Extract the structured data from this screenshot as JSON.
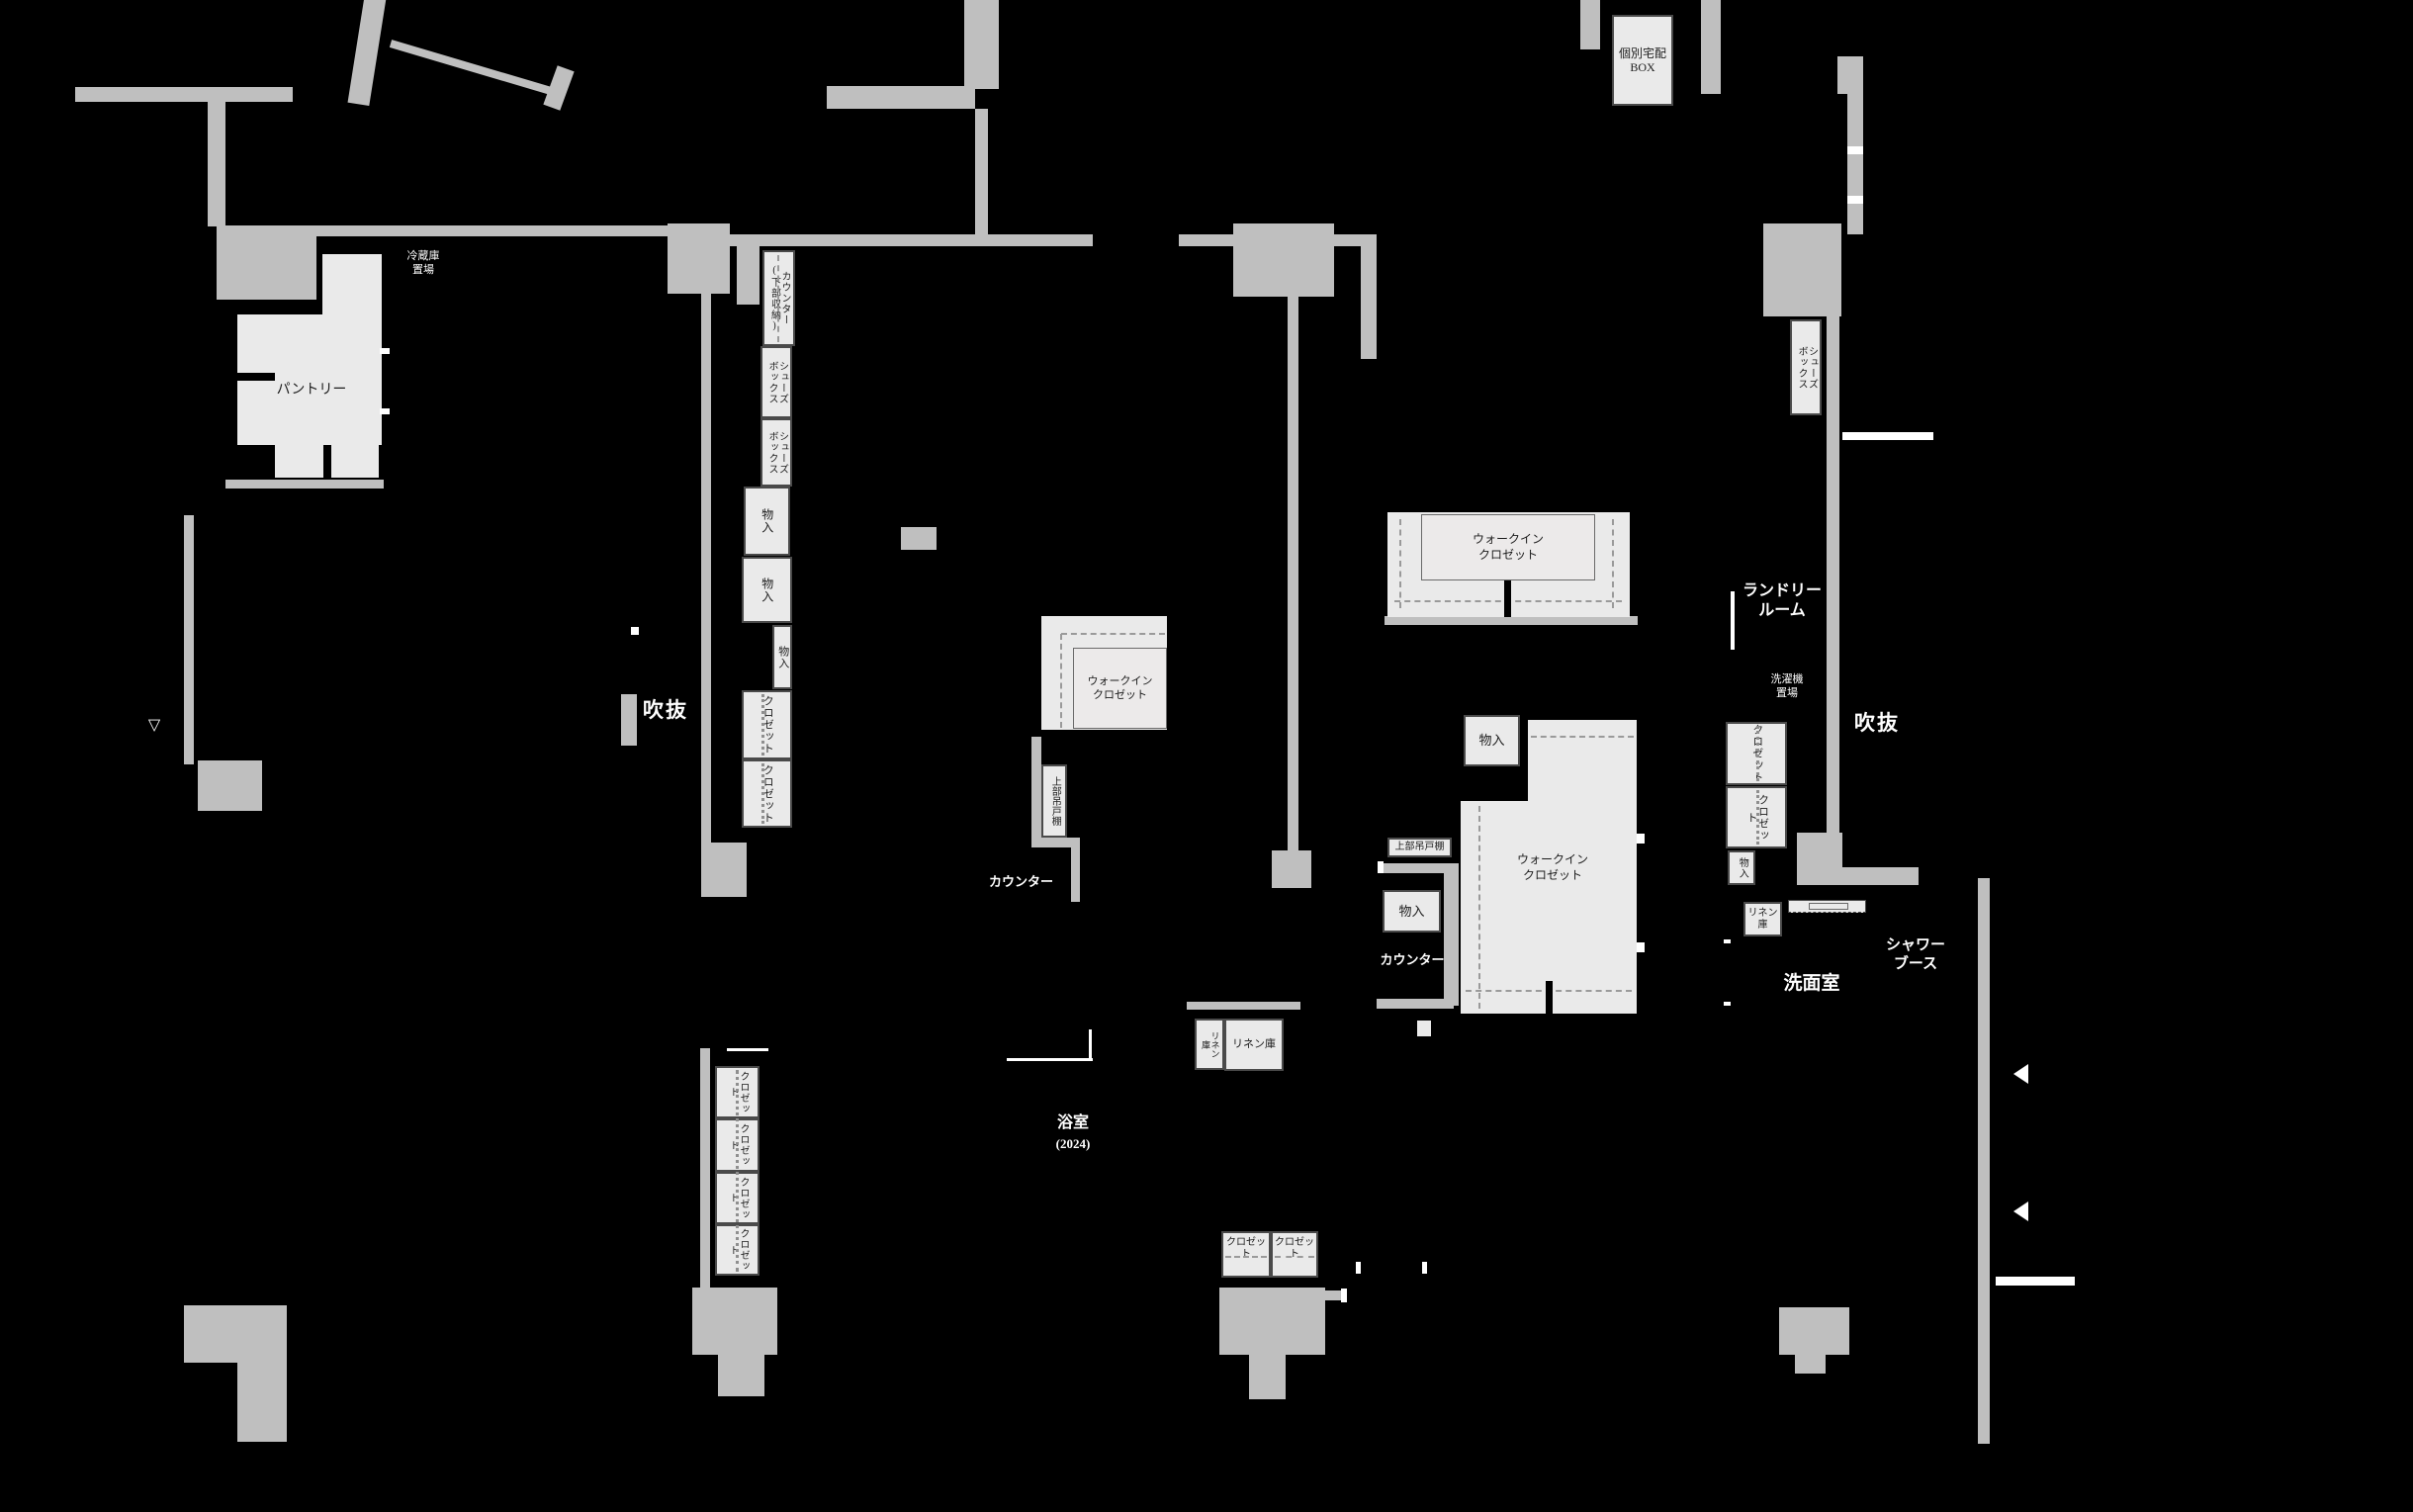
{
  "plan_type": "floor-plan",
  "colors": {
    "background": "#000000",
    "wall": "#bfbfbf",
    "storage_fill": "#eaeaea",
    "storage_border": "#4a4a4a",
    "label_dark": "#1c1c1c",
    "label_light": "#ffffff"
  },
  "labels": {
    "refrigerator_space": "冷蔵庫\n置場",
    "pantry": "パントリー",
    "counter_with_lower_storage": "カウンター\n(下部収納)",
    "shoes_box": "シューズ\nボックス",
    "storage": "物入",
    "closet": "クロゼット",
    "walk_in_closet": "ウォークイン\nクロゼット",
    "void": "吹抜",
    "upper_cabinet": "上部吊戸棚",
    "counter": "カウンター",
    "laundry_room": "ランドリー\nルーム",
    "washer_space": "洗濯機\n置場",
    "linen_storage": "リネン庫",
    "linen_storage_two_line": "リネン\n庫",
    "washroom": "洗面室",
    "shower_booth": "シャワー\nブース",
    "bathroom": "浴室",
    "bathroom_year": "(2024)",
    "delivery_box": "個別宅配\nBOX",
    "triangle_marker": "▽"
  }
}
